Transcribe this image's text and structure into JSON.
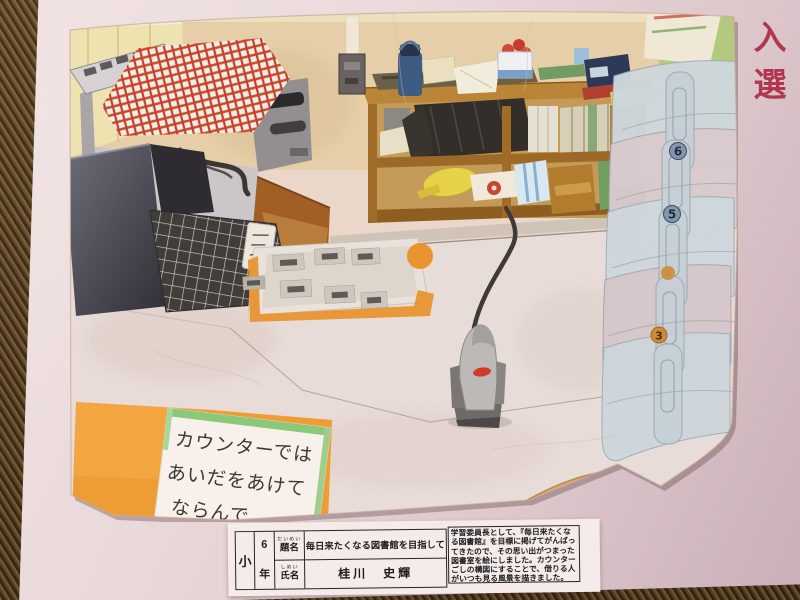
{
  "award": {
    "text": "入選"
  },
  "painting": {
    "sign_lines": [
      "カウンターでは",
      "あいだをあけて",
      "ならんで"
    ],
    "chair_numbers": {
      "top": "6",
      "middle": "5",
      "bottom": "3"
    }
  },
  "label_card": {
    "school_level": "小",
    "year_number": "6",
    "year_suffix": "年",
    "title_furigana": "だいめい",
    "title_label": "題名",
    "title_value": "毎日来たくなる図書館を目指して",
    "name_furigana": "しめい",
    "name_label": "氏名",
    "name_value": "桂川　史輝",
    "description": "学習委員長として、『毎日来たくな\nる図書館』を目標に掲げてがんばっ\nてきたので、その思い出がつまった\n図書室を絵にしました。カウンター\nごしの構図にすることで、借りる人\nがいつも見る風景を描きました。"
  },
  "colors": {
    "award_red": "#b23650",
    "mat_pink": "#e9d8d9",
    "counter_orange": "#ee9c34",
    "cloth_red": "#cc4a2c",
    "shelf_wood": "#ba8538"
  }
}
